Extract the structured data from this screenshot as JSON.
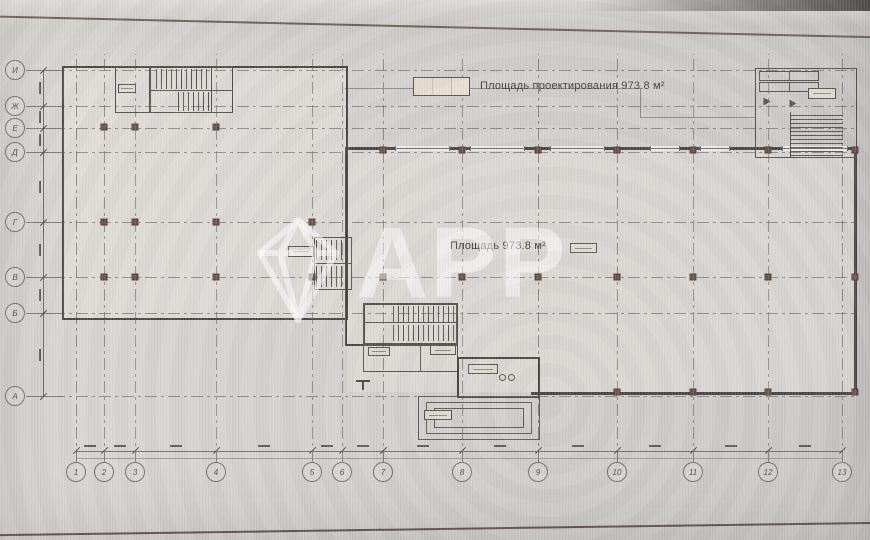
{
  "photo": {
    "background": "#d2d0cd",
    "screen_edge_top_color": "#6f5a50",
    "screen_edge_bottom_color": "#5d4a44"
  },
  "plan": {
    "legend_label": "Площадь проектирования 973.8 м²",
    "room_area_label": "Площадь 973.8 м²"
  },
  "watermark": {
    "text": "APP"
  },
  "axes": {
    "left": [
      {
        "label": "И",
        "y": 70
      },
      {
        "label": "Ж",
        "y": 106
      },
      {
        "label": "Е",
        "y": 128
      },
      {
        "label": "Д",
        "y": 152
      },
      {
        "label": "Г",
        "y": 222
      },
      {
        "label": "В",
        "y": 277
      },
      {
        "label": "Б",
        "y": 313
      },
      {
        "label": "А",
        "y": 396
      }
    ],
    "bottom": [
      {
        "label": "1",
        "x": 76
      },
      {
        "label": "2",
        "x": 104
      },
      {
        "label": "3",
        "x": 135
      },
      {
        "label": "4",
        "x": 216
      },
      {
        "label": "5",
        "x": 312
      },
      {
        "label": "6",
        "x": 342
      },
      {
        "label": "7",
        "x": 383
      },
      {
        "label": "8",
        "x": 462
      },
      {
        "label": "9",
        "x": 538
      },
      {
        "label": "10",
        "x": 617
      },
      {
        "label": "11",
        "x": 693
      },
      {
        "label": "12",
        "x": 768
      },
      {
        "label": "13",
        "x": 842
      }
    ]
  },
  "columns": [
    [
      383,
      150
    ],
    [
      462,
      150
    ],
    [
      538,
      150
    ],
    [
      617,
      150
    ],
    [
      693,
      150
    ],
    [
      768,
      150
    ],
    [
      855,
      150
    ],
    [
      383,
      277
    ],
    [
      462,
      277
    ],
    [
      538,
      277
    ],
    [
      617,
      277
    ],
    [
      693,
      277
    ],
    [
      768,
      277
    ],
    [
      855,
      277
    ],
    [
      617,
      392
    ],
    [
      693,
      392
    ],
    [
      768,
      392
    ],
    [
      855,
      392
    ],
    [
      104,
      222
    ],
    [
      135,
      222
    ],
    [
      216,
      222
    ],
    [
      312,
      222
    ],
    [
      104,
      277
    ],
    [
      135,
      277
    ],
    [
      216,
      277
    ],
    [
      312,
      277
    ],
    [
      104,
      127
    ],
    [
      135,
      127
    ],
    [
      216,
      127
    ]
  ],
  "label_boxes": [
    [
      118,
      84,
      18,
      9
    ],
    [
      288,
      246,
      26,
      11
    ],
    [
      570,
      243,
      27,
      10
    ],
    [
      808,
      88,
      28,
      11
    ],
    [
      368,
      347,
      22,
      9
    ],
    [
      430,
      345,
      26,
      10
    ],
    [
      468,
      364,
      30,
      10
    ],
    [
      424,
      410,
      28,
      10
    ]
  ],
  "colors": {
    "wall": "#45423d",
    "grid": "#85847e",
    "column": "#6e4f43",
    "watermark": "rgba(255,255,255,0.52)"
  }
}
